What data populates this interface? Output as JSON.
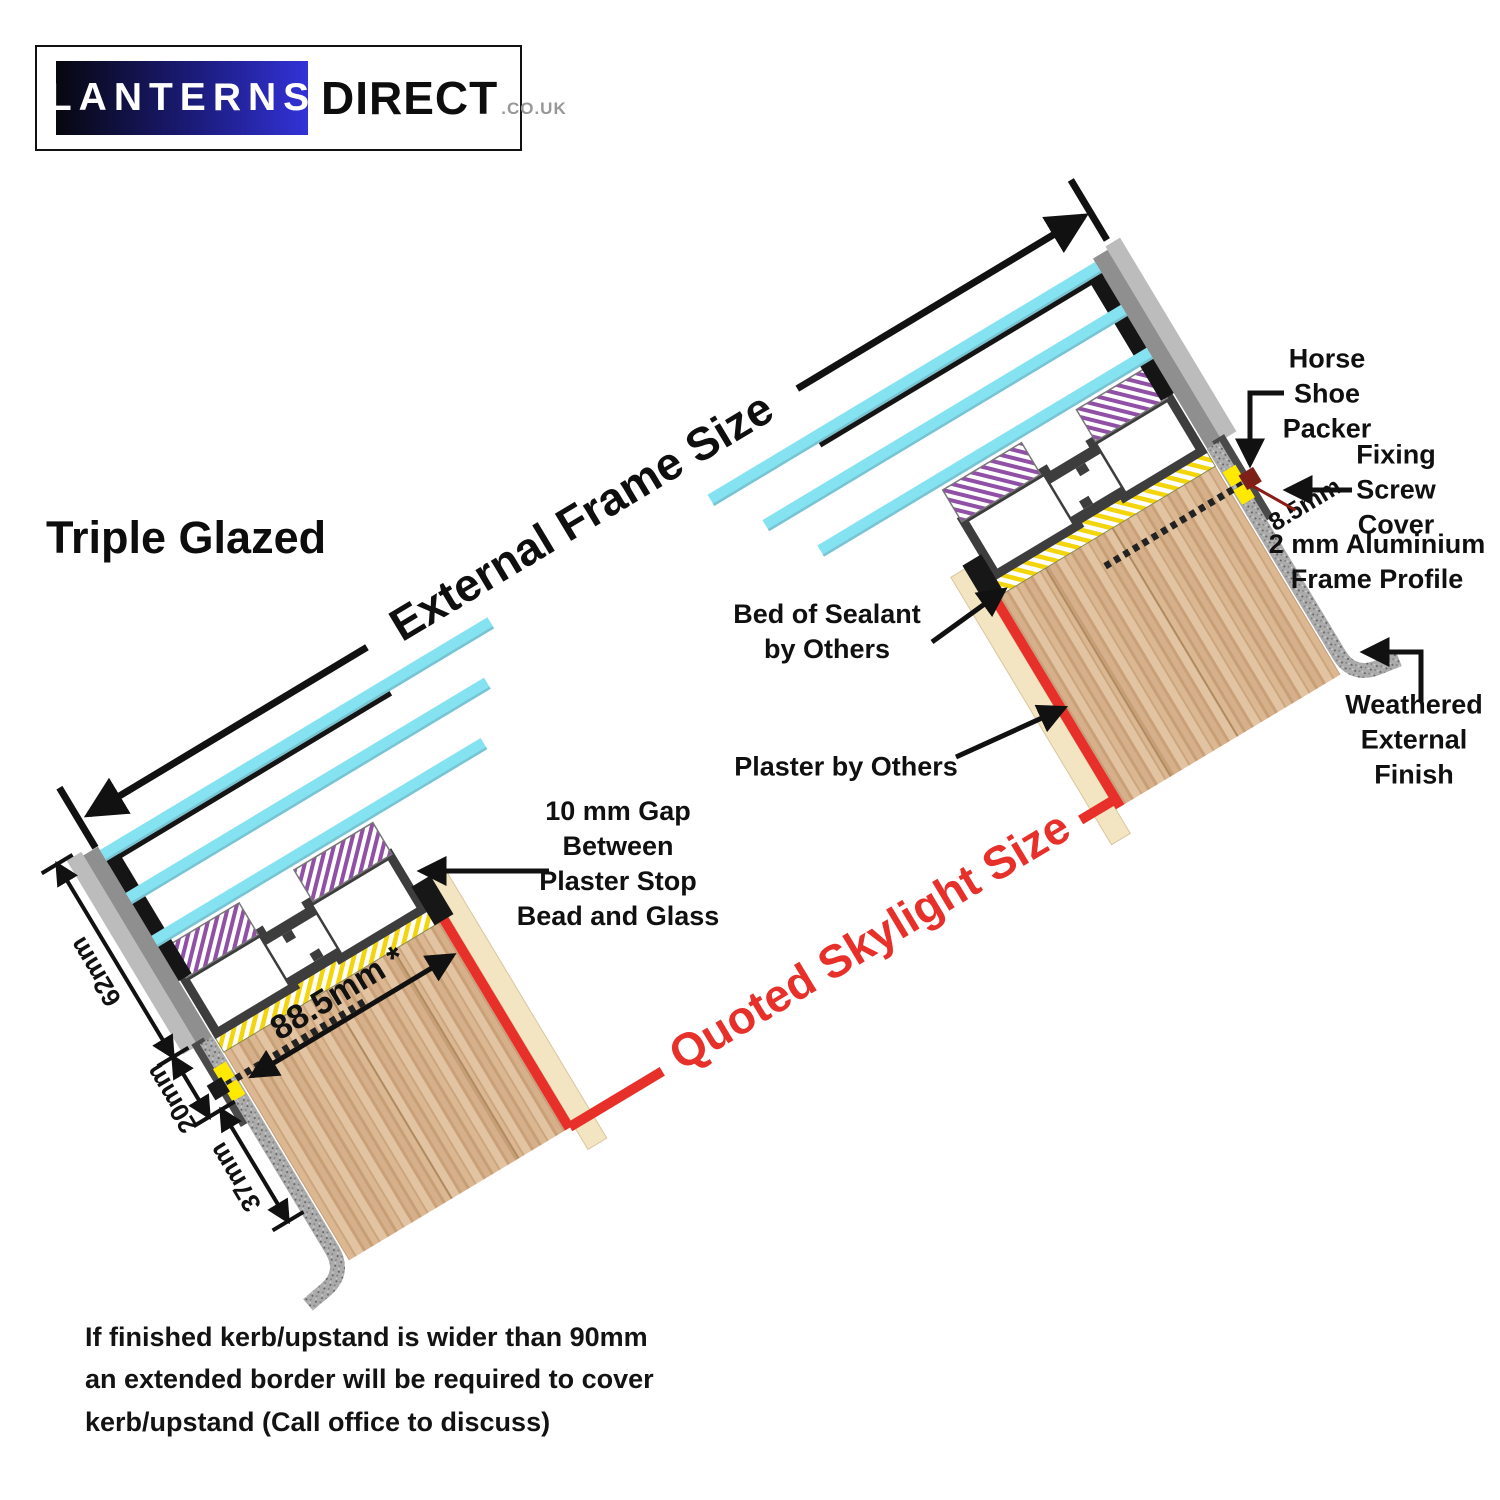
{
  "logo": {
    "brand_primary": "LANTERNS",
    "brand_secondary": "DIRECT",
    "tld": ".CO.UK"
  },
  "heading": {
    "title": "Triple Glazed"
  },
  "diagram": {
    "frame_dimension_label": "External Frame Size",
    "skylight_dimension_label": "Quoted Skylight Size",
    "dims": {
      "d62": "62mm",
      "d20": "20mm",
      "d37": "37mm",
      "d885": "88.5mm *",
      "d85": "8.5mm"
    },
    "labels": {
      "horse_shoe": {
        "lines": [
          "Horse",
          "Shoe",
          "Packer"
        ]
      },
      "fixing_screw": {
        "lines": [
          "Fixing",
          "Screw",
          "Cover"
        ]
      },
      "frame_profile": {
        "lines": [
          "2 mm Aluminium",
          "Frame Profile"
        ]
      },
      "weathered": {
        "lines": [
          "Weathered",
          "External",
          "Finish"
        ]
      },
      "bed_sealant": {
        "lines": [
          "Bed of Sealant",
          "by Others"
        ]
      },
      "plaster": {
        "lines": [
          "Plaster by Others"
        ]
      },
      "gap10": {
        "lines": [
          "10 mm Gap",
          "Between",
          "Plaster Stop",
          "Bead and Glass"
        ]
      }
    },
    "colors": {
      "accent_red": "#E8302A",
      "glass_cyan": "#85E2F1",
      "frame_grey": "#3D3D3D",
      "kerb_wood": "#D9B390",
      "packer_yellow": "#FFE900"
    }
  },
  "note": {
    "lines": [
      "If finished kerb/upstand is wider than 90mm",
      "an extended border will be required to cover",
      "kerb/upstand (Call office to discuss)"
    ]
  }
}
